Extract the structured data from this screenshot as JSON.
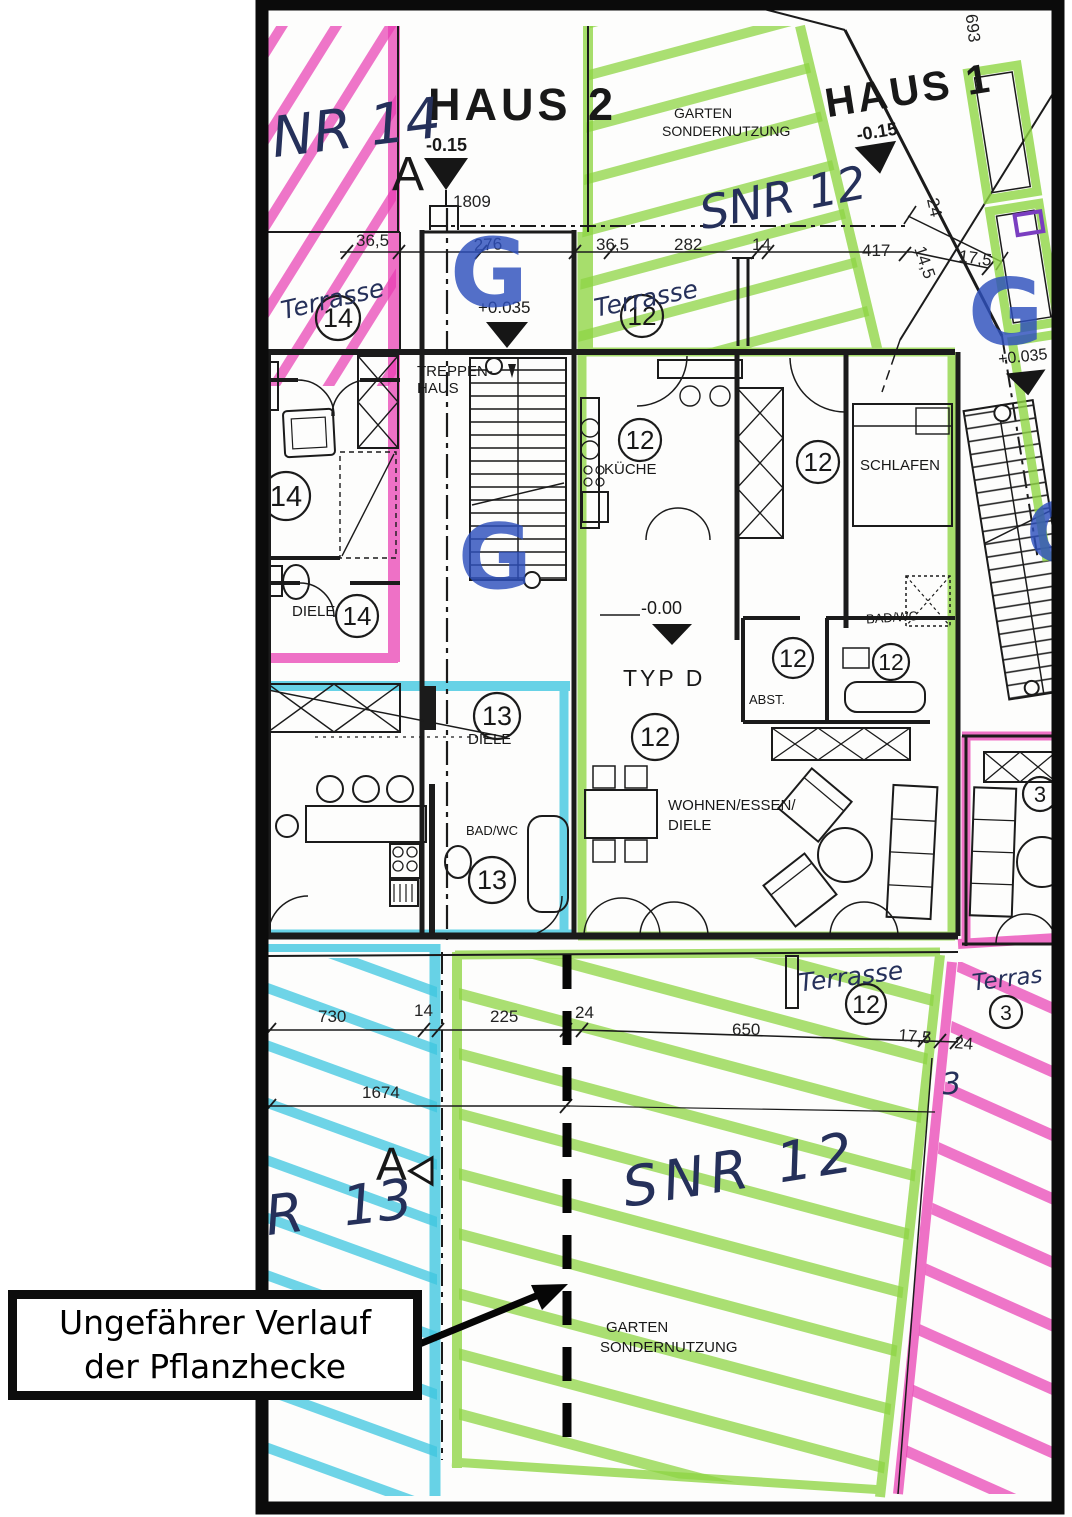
{
  "colors": {
    "pink": "#e93cb2",
    "green": "#8fd644",
    "cyan": "#3ec7e0",
    "stamp_blue": "#2e50bd",
    "ink": "#1b1b1b",
    "paper": "#fdfdfc",
    "violet": "#7a3ec0"
  },
  "buildings": {
    "haus2": "HAUS 2",
    "haus1": "HAUS 1"
  },
  "areas": {
    "garten": "GARTEN",
    "sondernutzung": "SONDERNUTZUNG"
  },
  "handwritten": {
    "nr14": "NR 14",
    "snr12": "SNR 12",
    "snr13": "R 13",
    "three": "3",
    "terrasse": "Terrasse",
    "terrasse_cut": "Terras"
  },
  "rooms": {
    "treppenhaus_1": "TREPPEN-",
    "treppenhaus_2": "HAUS",
    "kueche": "KÜCHE",
    "schlafen": "SCHLAFEN",
    "badwc": "BAD/WC",
    "abst": "ABST.",
    "typ_d": "TYP D",
    "wohnen_1": "WOHNEN/ESSEN/",
    "diele": "DIELE"
  },
  "units": {
    "u3": "3",
    "u12": "12",
    "u13": "13",
    "u14": "14"
  },
  "levels": {
    "minus_015": "-0.15",
    "plus_0035": "+0.035",
    "minus_000": "-0.00"
  },
  "markers": {
    "section_a": "A",
    "g_stamp": "G"
  },
  "dims": {
    "d1809": "1809",
    "d276": "276",
    "d365": "36,5",
    "d282": "282",
    "d14": "14",
    "d417": "417",
    "d175": "17,5",
    "d24": "24",
    "d145": "14,5",
    "d693": "693",
    "d730": "730",
    "d225": "225",
    "d650": "650",
    "d1674": "1674"
  },
  "annotation": {
    "line1": "Ungefährer Verlauf",
    "line2": "der Pflanzhecke"
  }
}
